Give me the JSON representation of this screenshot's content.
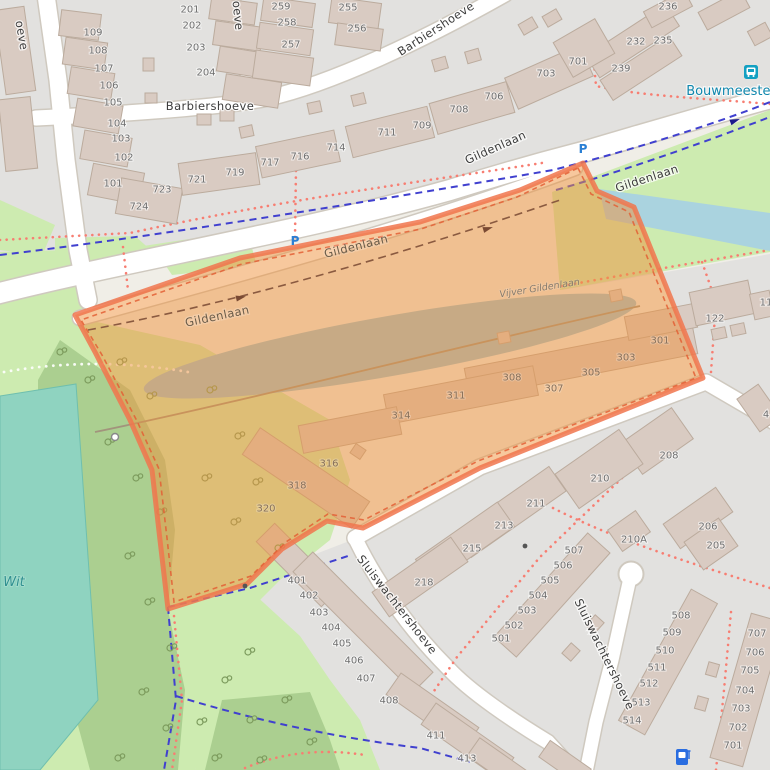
{
  "map": {
    "description": "OpenStreetMap residential area with orange highlighted selection polygon over Gildenlaan",
    "colors": {
      "land": "#f0eee7",
      "residential": "#e2e1df",
      "building_fill": "#d9cbc2",
      "building_stroke": "#bbab9d",
      "road_fill": "#ffffff",
      "road_casing": "#cfc9bf",
      "grass": "#cdebb0",
      "scrub": "#abcf90",
      "pool_water": "#8fd3c0",
      "canal_water": "#aad3df",
      "pond_water": "#9fc3cf",
      "footpath": "#f77e72",
      "cycleway": "#4040cf",
      "highlight_fill": "#f0923c",
      "highlight_stroke": "#f0764d",
      "transit": "#0f87ad",
      "water_label": "#2f9090"
    },
    "street_labels": [
      {
        "text": "Barbiershoeve",
        "x": 210,
        "y": 110,
        "r": 0,
        "type": "street"
      },
      {
        "text": "Barbiershoeve",
        "x": 438,
        "y": 32,
        "r": -33,
        "type": "street"
      },
      {
        "text": "oeve",
        "x": 18,
        "y": 36,
        "r": 80,
        "type": "street"
      },
      {
        "text": "oeve",
        "x": 234,
        "y": 16,
        "r": 84,
        "type": "street"
      },
      {
        "text": "Gildenlaan",
        "x": 497,
        "y": 151,
        "r": -24,
        "type": "street"
      },
      {
        "text": "Gildenlaan",
        "x": 648,
        "y": 182,
        "r": -18,
        "type": "street"
      },
      {
        "text": "Gildenlaan",
        "x": 357,
        "y": 250,
        "r": -14,
        "type": "street-tinted"
      },
      {
        "text": "Gildenlaan",
        "x": 218,
        "y": 320,
        "r": -12,
        "type": "street-tinted"
      },
      {
        "text": "Sluiswachtershoeve",
        "x": 394,
        "y": 607,
        "r": 52,
        "type": "street"
      },
      {
        "text": "Sluiswachtershoeve",
        "x": 601,
        "y": 656,
        "r": 64,
        "type": "street"
      },
      {
        "text": "Vijver Gildenlaan",
        "x": 540,
        "y": 291,
        "r": -9,
        "type": "water-small"
      },
      {
        "text": "Wit",
        "x": 14,
        "y": 586,
        "r": 0,
        "type": "water"
      },
      {
        "text": "Bouwmeester",
        "x": 731,
        "y": 95,
        "r": 0,
        "type": "transit"
      },
      {
        "text": "P",
        "x": 295,
        "y": 245,
        "r": 0,
        "type": "parking"
      },
      {
        "text": "P",
        "x": 583,
        "y": 153,
        "r": 0,
        "type": "parking"
      }
    ],
    "house_numbers": [
      [
        "109",
        93,
        32
      ],
      [
        "108",
        98,
        50
      ],
      [
        "107",
        104,
        68
      ],
      [
        "106",
        109,
        85
      ],
      [
        "105",
        113,
        102
      ],
      [
        "104",
        117,
        123
      ],
      [
        "103",
        121,
        138
      ],
      [
        "102",
        124,
        157
      ],
      [
        "101",
        113,
        183
      ],
      [
        "201",
        190,
        9
      ],
      [
        "202",
        192,
        25
      ],
      [
        "203",
        196,
        47
      ],
      [
        "204",
        206,
        72
      ],
      [
        "259",
        281,
        6
      ],
      [
        "258",
        287,
        22
      ],
      [
        "257",
        291,
        44
      ],
      [
        "255",
        348,
        7
      ],
      [
        "256",
        357,
        28
      ],
      [
        "236",
        668,
        6
      ],
      [
        "232",
        636,
        41
      ],
      [
        "235",
        663,
        40
      ],
      [
        "239",
        621,
        68
      ],
      [
        "701",
        578,
        61
      ],
      [
        "703",
        546,
        73
      ],
      [
        "706",
        494,
        96
      ],
      [
        "708",
        459,
        109
      ],
      [
        "709",
        422,
        125
      ],
      [
        "711",
        387,
        132
      ],
      [
        "714",
        336,
        147
      ],
      [
        "716",
        300,
        156
      ],
      [
        "717",
        270,
        162
      ],
      [
        "719",
        235,
        172
      ],
      [
        "721",
        197,
        179
      ],
      [
        "723",
        162,
        189
      ],
      [
        "724",
        139,
        206
      ],
      [
        "122",
        715,
        318
      ],
      [
        "11",
        766,
        302
      ],
      [
        "301",
        660,
        340,
        1
      ],
      [
        "303",
        626,
        357,
        1
      ],
      [
        "305",
        591,
        372,
        1
      ],
      [
        "307",
        554,
        388,
        1
      ],
      [
        "308",
        512,
        377,
        1
      ],
      [
        "311",
        456,
        395,
        1
      ],
      [
        "314",
        401,
        415,
        1
      ],
      [
        "316",
        329,
        463,
        1
      ],
      [
        "318",
        297,
        485,
        1
      ],
      [
        "320",
        266,
        508,
        1
      ],
      [
        "208",
        669,
        455
      ],
      [
        "210",
        600,
        478
      ],
      [
        "4",
        766,
        414
      ],
      [
        "211",
        536,
        503
      ],
      [
        "213",
        504,
        525
      ],
      [
        "215",
        472,
        548
      ],
      [
        "218",
        424,
        582
      ],
      [
        "210A",
        634,
        539
      ],
      [
        "206",
        708,
        526
      ],
      [
        "205",
        716,
        545
      ],
      [
        "401",
        297,
        580
      ],
      [
        "402",
        309,
        595
      ],
      [
        "403",
        319,
        612
      ],
      [
        "404",
        331,
        627
      ],
      [
        "405",
        342,
        643
      ],
      [
        "406",
        354,
        660
      ],
      [
        "407",
        366,
        678
      ],
      [
        "408",
        389,
        700
      ],
      [
        "411",
        436,
        735
      ],
      [
        "413",
        467,
        758
      ],
      [
        "501",
        501,
        638
      ],
      [
        "502",
        514,
        625
      ],
      [
        "503",
        527,
        610
      ],
      [
        "504",
        538,
        595
      ],
      [
        "505",
        550,
        580
      ],
      [
        "506",
        563,
        565
      ],
      [
        "507",
        574,
        550
      ],
      [
        "508",
        681,
        615
      ],
      [
        "509",
        672,
        632
      ],
      [
        "510",
        665,
        650
      ],
      [
        "511",
        657,
        667
      ],
      [
        "512",
        649,
        683
      ],
      [
        "513",
        641,
        702
      ],
      [
        "514",
        632,
        720
      ],
      [
        "707",
        757,
        633
      ],
      [
        "706",
        755,
        652
      ],
      [
        "705",
        750,
        670
      ],
      [
        "704",
        745,
        690
      ],
      [
        "703",
        741,
        708
      ],
      [
        "702",
        738,
        727
      ],
      [
        "701",
        733,
        745
      ]
    ],
    "icons": [
      {
        "name": "bus-stop-icon",
        "x": 751,
        "y": 72
      },
      {
        "name": "parking-icon-note",
        "x": 0,
        "y": 0
      },
      {
        "name": "charging-station-icon",
        "x": 683,
        "y": 757
      },
      {
        "name": "gate-icon",
        "x": 115,
        "y": 437
      },
      {
        "name": "bollard-icon",
        "x": 245,
        "y": 586
      },
      {
        "name": "bollard-icon",
        "x": 525,
        "y": 546
      }
    ],
    "oneway_arrows": [
      {
        "x": 243,
        "y": 297,
        "r": -13
      },
      {
        "x": 490,
        "y": 228,
        "r": -17
      },
      {
        "x": 737,
        "y": 120,
        "r": -20
      }
    ]
  }
}
